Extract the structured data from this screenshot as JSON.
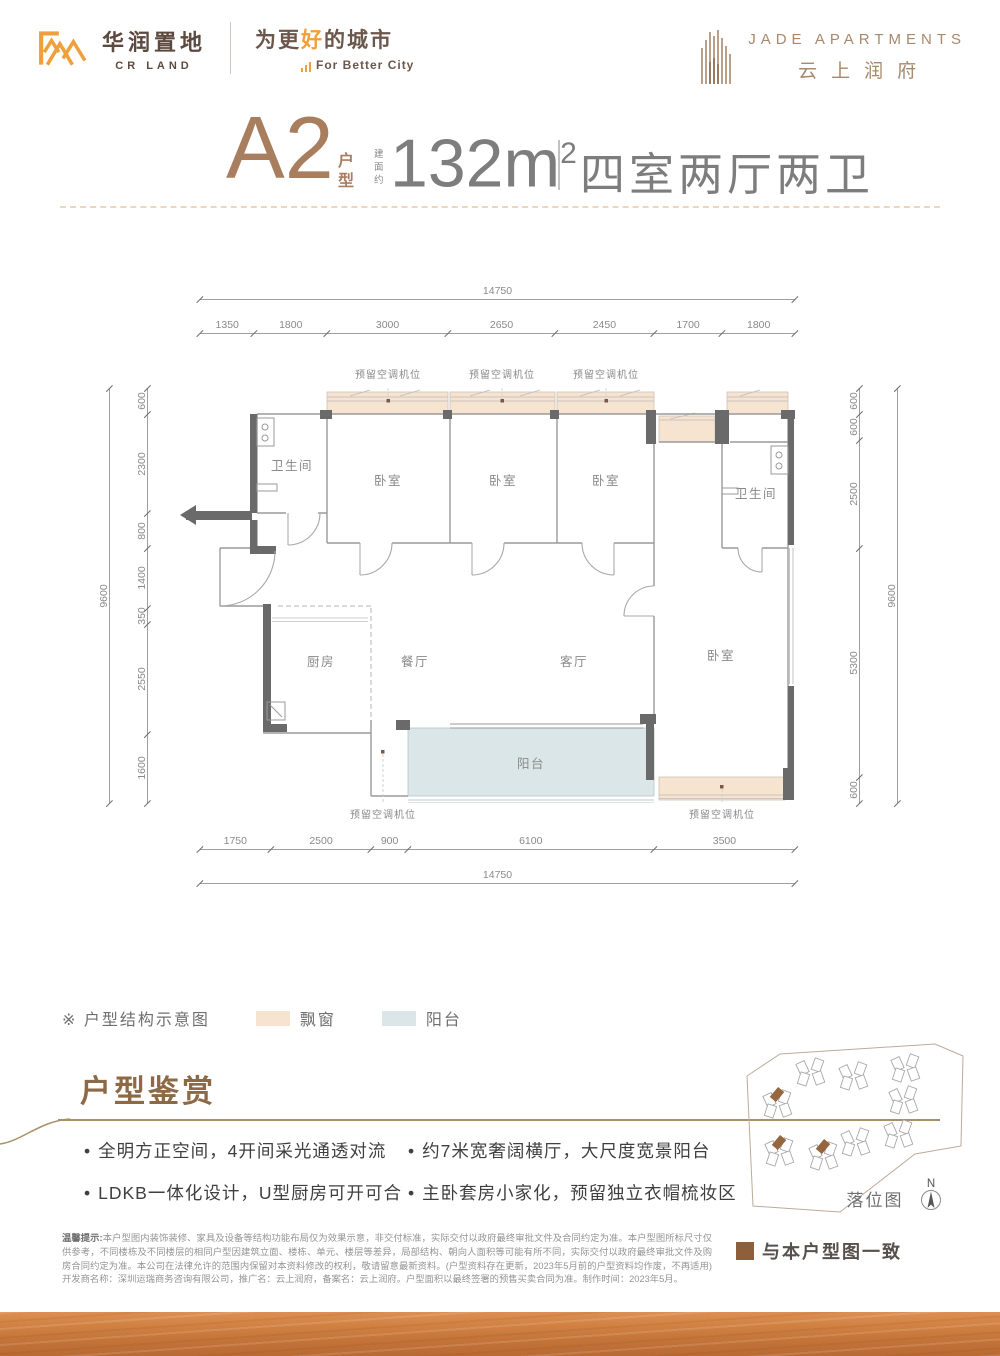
{
  "header": {
    "cr_logo": {
      "brand_cn": "华润置地",
      "brand_en": "CR LAND",
      "slogan_cn_pre": "为更",
      "slogan_cn_accent": "好",
      "slogan_cn_post": "的城市",
      "slogan_en": "For Better City"
    },
    "jade_logo": {
      "name_en": "JADE APARTMENTS",
      "name_cn": "云上润府"
    }
  },
  "title": {
    "unit": "A2",
    "unit_suffix_1": "户",
    "unit_suffix_2": "型",
    "area_prefix_1": "建",
    "area_prefix_2": "面",
    "area_prefix_3": "约",
    "area": "132m",
    "area_sup": "2",
    "layout": "四室两厅两卫"
  },
  "plan": {
    "rooms": {
      "bath_left": "卫生间",
      "bed1": "卧室",
      "bed2": "卧室",
      "bed3": "卧室",
      "bath_right": "卫生间",
      "kitchen": "厨房",
      "dining": "餐厅",
      "living": "客厅",
      "bed_master": "卧室",
      "balcony": "阳台"
    },
    "ac_label": "预留空调机位",
    "dims": {
      "top_overall": [
        14750
      ],
      "top": [
        1350,
        1800,
        3000,
        2650,
        2450,
        1700,
        1800
      ],
      "bottom": [
        1750,
        2500,
        900,
        6100,
        3500
      ],
      "bottom_overall": [
        14750
      ],
      "left_overall": [
        9600
      ],
      "left": [
        600,
        2300,
        800,
        1400,
        350,
        2550,
        1600
      ],
      "right": [
        600,
        600,
        2500,
        5300,
        600
      ],
      "right_overall": [
        9600
      ]
    }
  },
  "legend": {
    "note": "※ 户型结构示意图",
    "bay_window": "飘窗",
    "balcony": "阳台",
    "bay_color": "#f6e3d0",
    "balcony_color": "#dbe6e8"
  },
  "features": {
    "title": "户型鉴赏",
    "items": [
      "全明方正空间，4开间采光通透对流",
      "LDKB一体化设计，U型厨房可开可合",
      "约7米宽奢阔横厅，大尺度宽景阳台",
      "主卧套房小家化，预留独立衣帽梳妆区"
    ]
  },
  "siteplan": {
    "label": "落位图",
    "north": "N",
    "legend": "与本户型图一致",
    "highlight_color": "#96663f"
  },
  "disclaimer": {
    "lead": "温馨提示:",
    "body": "本户型图内装饰装修、家具及设备等结构功能布局仅为效果示意，非交付标准，实际交付以政府最终审批文件及合同约定为准。本户型图所标尺寸仅供参考，不同楼栋及不同楼层的相同户型因建筑立面、楼栋、单元、楼层等差异，局部结构、朝向人面积等可能有所不同，实际交付以政府最终审批文件及购房合同约定为准。本公司在法律允许的范围内保留对本资料修改的权利，敬请留意最新资料。(户型资料存在更新，2023年5月前的户型资料均作废，不再适用) 开发商名称：深圳运瑞商务咨询有限公司，推广名：云上润府，备案名：云上润府。户型面积以最终签署的预售买卖合同为准。制作时间：2023年5月。"
  },
  "colors": {
    "accent_orange": "#ef9f3c",
    "brand_brown": "#5c4a40",
    "title_brown": "#a97e5f",
    "jade_tan": "#a8896c",
    "wall_gray": "#6a6a6a",
    "bay": "#f6e3d0",
    "balcony": "#dbe6e8",
    "highlight_brown": "#8f5f3c"
  }
}
